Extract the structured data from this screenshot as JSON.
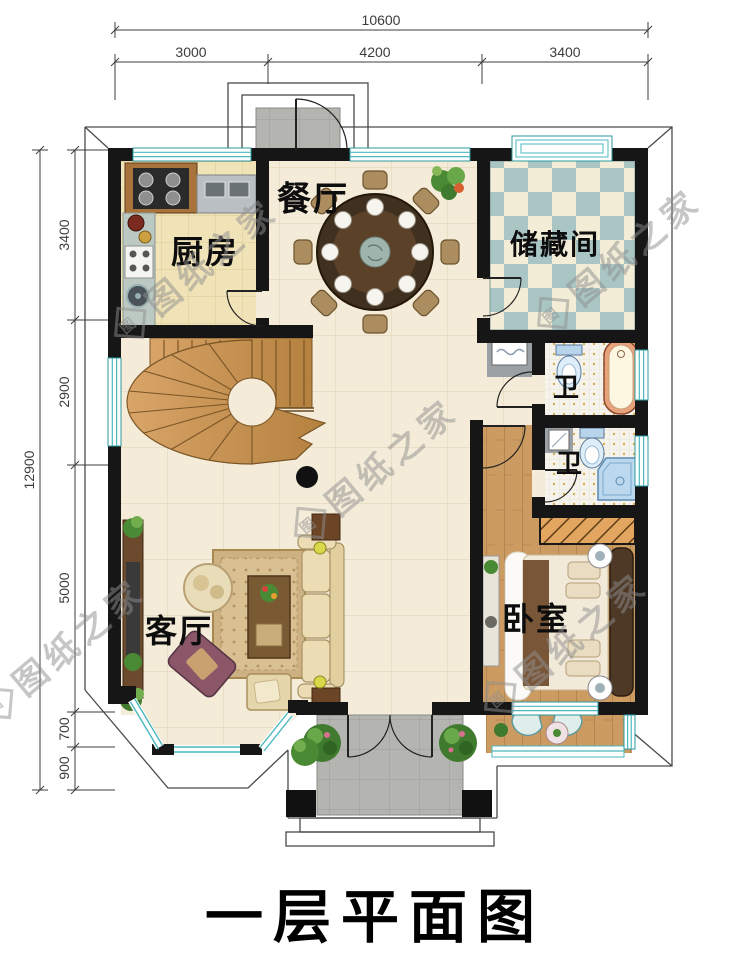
{
  "title": "一层平面图",
  "dimensions": {
    "top": {
      "total": "10600",
      "segments": [
        "3000",
        "4200",
        "3400"
      ]
    },
    "left": {
      "total": "12900",
      "segments": [
        "3400",
        "2900",
        "5000",
        "700",
        "900"
      ]
    }
  },
  "rooms": {
    "dining": "餐厅",
    "kitchen": "厨房",
    "storage": "储藏间",
    "bath_upper": "卫",
    "bath_lower": "卫",
    "bedroom": "卧室",
    "living": "客厅"
  },
  "watermark": {
    "text": "图纸之家",
    "logo_char": "图"
  },
  "colors": {
    "wall": "#161616",
    "window_teal": "#49b8bf",
    "floor_hall": "#f4ecd8",
    "floor_kitchen": "#f1e3b8",
    "floor_bedroom_wood": "#cb9b62",
    "storage_check_teal": "#a9c6c4",
    "storage_check_cream": "#f3edd7",
    "stair_wood": "#c9904f",
    "porch_gray": "#b4b4b1",
    "bathtub_rim": "#e8a27c",
    "shower_blue": "#bcd8ee",
    "sofa_cream": "#ecdcb4",
    "rug_tan": "#d3b98b"
  }
}
